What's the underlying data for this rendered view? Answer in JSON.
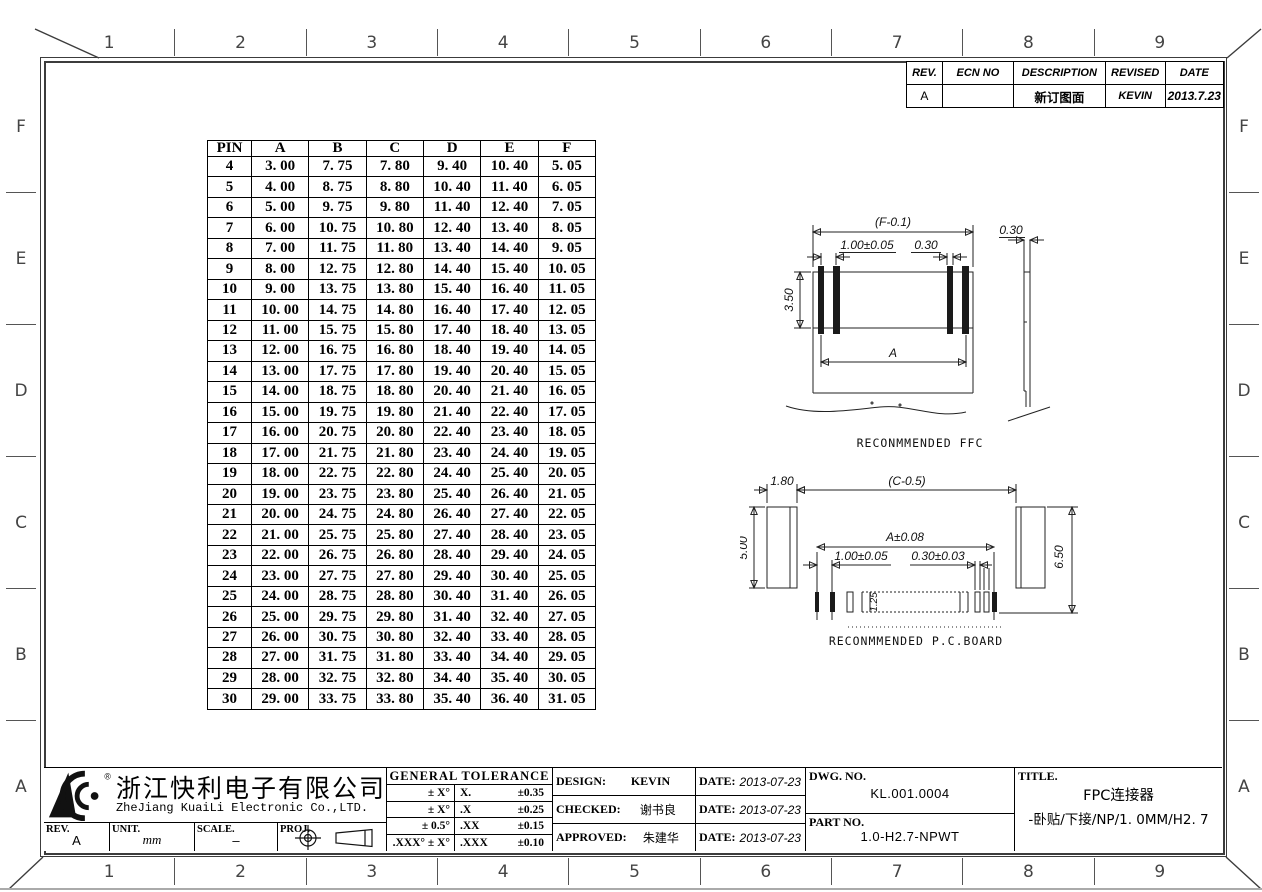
{
  "sheet": {
    "zone_columns": [
      "1",
      "2",
      "3",
      "4",
      "5",
      "6",
      "7",
      "8",
      "9"
    ],
    "zone_rows": [
      "F",
      "E",
      "D",
      "C",
      "B",
      "A"
    ]
  },
  "revision_table": {
    "headers": [
      "REV.",
      "ECN NO",
      "DESCRIPTION",
      "REVISED",
      "DATE"
    ],
    "rows": [
      [
        "A",
        "",
        "新订图面",
        "KEVIN",
        "2013.7.23"
      ]
    ]
  },
  "pin_table": {
    "headers": [
      "PIN",
      "A",
      "B",
      "C",
      "D",
      "E",
      "F"
    ],
    "rows": [
      [
        "4",
        "3. 00",
        "7. 75",
        "7. 80",
        "9. 40",
        "10. 40",
        "5. 05"
      ],
      [
        "5",
        "4. 00",
        "8. 75",
        "8. 80",
        "10. 40",
        "11. 40",
        "6. 05"
      ],
      [
        "6",
        "5. 00",
        "9. 75",
        "9. 80",
        "11. 40",
        "12. 40",
        "7. 05"
      ],
      [
        "7",
        "6. 00",
        "10. 75",
        "10. 80",
        "12. 40",
        "13. 40",
        "8. 05"
      ],
      [
        "8",
        "7. 00",
        "11. 75",
        "11. 80",
        "13. 40",
        "14. 40",
        "9. 05"
      ],
      [
        "9",
        "8. 00",
        "12. 75",
        "12. 80",
        "14. 40",
        "15. 40",
        "10. 05"
      ],
      [
        "10",
        "9. 00",
        "13. 75",
        "13. 80",
        "15. 40",
        "16. 40",
        "11. 05"
      ],
      [
        "11",
        "10. 00",
        "14. 75",
        "14. 80",
        "16. 40",
        "17. 40",
        "12. 05"
      ],
      [
        "12",
        "11. 00",
        "15. 75",
        "15. 80",
        "17. 40",
        "18. 40",
        "13. 05"
      ],
      [
        "13",
        "12. 00",
        "16. 75",
        "16. 80",
        "18. 40",
        "19. 40",
        "14. 05"
      ],
      [
        "14",
        "13. 00",
        "17. 75",
        "17. 80",
        "19. 40",
        "20. 40",
        "15. 05"
      ],
      [
        "15",
        "14. 00",
        "18. 75",
        "18. 80",
        "20. 40",
        "21. 40",
        "16. 05"
      ],
      [
        "16",
        "15. 00",
        "19. 75",
        "19. 80",
        "21. 40",
        "22. 40",
        "17. 05"
      ],
      [
        "17",
        "16. 00",
        "20. 75",
        "20. 80",
        "22. 40",
        "23. 40",
        "18. 05"
      ],
      [
        "18",
        "17. 00",
        "21. 75",
        "21. 80",
        "23. 40",
        "24. 40",
        "19. 05"
      ],
      [
        "19",
        "18. 00",
        "22. 75",
        "22. 80",
        "24. 40",
        "25. 40",
        "20. 05"
      ],
      [
        "20",
        "19. 00",
        "23. 75",
        "23. 80",
        "25. 40",
        "26. 40",
        "21. 05"
      ],
      [
        "21",
        "20. 00",
        "24. 75",
        "24. 80",
        "26. 40",
        "27. 40",
        "22. 05"
      ],
      [
        "22",
        "21. 00",
        "25. 75",
        "25. 80",
        "27. 40",
        "28. 40",
        "23. 05"
      ],
      [
        "23",
        "22. 00",
        "26. 75",
        "26. 80",
        "28. 40",
        "29. 40",
        "24. 05"
      ],
      [
        "24",
        "23. 00",
        "27. 75",
        "27. 80",
        "29. 40",
        "30. 40",
        "25. 05"
      ],
      [
        "25",
        "24. 00",
        "28. 75",
        "28. 80",
        "30. 40",
        "31. 40",
        "26. 05"
      ],
      [
        "26",
        "25. 00",
        "29. 75",
        "29. 80",
        "31. 40",
        "32. 40",
        "27. 05"
      ],
      [
        "27",
        "26. 00",
        "30. 75",
        "30. 80",
        "32. 40",
        "33. 40",
        "28. 05"
      ],
      [
        "28",
        "27. 00",
        "31. 75",
        "31. 80",
        "33. 40",
        "34. 40",
        "29. 05"
      ],
      [
        "29",
        "28. 00",
        "32. 75",
        "32. 80",
        "34. 40",
        "35. 40",
        "30. 05"
      ],
      [
        "30",
        "29. 00",
        "33. 75",
        "33. 80",
        "35. 40",
        "36. 40",
        "31. 05"
      ]
    ]
  },
  "ffc_drawing": {
    "label": "RECONMMENDED FFC",
    "dim_overall": "(F-0.1)",
    "dim_pitch": "1.00±0.05",
    "dim_conductor_width": "0.30",
    "dim_height": "3.50",
    "dim_span": "A",
    "dim_thickness": "0.30"
  },
  "pcb_drawing": {
    "label": "RECONMMENDED P.C.BOARD",
    "dim_end_width": "1.80",
    "dim_overall": "(C-0.5)",
    "dim_end_height": "5.00",
    "dim_span": "A±0.08",
    "dim_pitch": "1.00±0.05",
    "dim_pad_width": "0.30±0.03",
    "dim_pad_length": "1.25",
    "dim_total_height": "6.50"
  },
  "title_block": {
    "logo_mark": "®",
    "company_cn": "浙江快利电子有限公司",
    "company_en": "ZheJiang KuaiLi Electronic Co.,LTD.",
    "rev_label": "REV.",
    "rev_value": "A",
    "unit_label": "UNIT.",
    "unit_value": "mm",
    "scale_label": "SCALE.",
    "scale_value": "–",
    "proj_label": "PROJ.",
    "tolerance": {
      "title": "GENERAL TOLERANCE",
      "rows": [
        [
          "± X°",
          "X.",
          "±0.35"
        ],
        [
          "± X°",
          ".X",
          "±0.25"
        ],
        [
          "± 0.5°",
          ".XX",
          "±0.15"
        ],
        [
          ".XXX° ± X°",
          ".XXX",
          "±0.10"
        ]
      ]
    },
    "design_label": "DESIGN:",
    "design_value": "KEVIN",
    "design_date": "2013-07-23",
    "checked_label": "CHECKED:",
    "checked_value": "谢书良",
    "checked_date": "2013-07-23",
    "approved_label": "APPROVED:",
    "approved_value": "朱建华",
    "approved_date": "2013-07-23",
    "date_label": "DATE:",
    "dwg_no_label": "DWG. NO.",
    "dwg_no": "KL.001.0004",
    "part_no_label": "PART NO.",
    "part_no": "1.0-H2.7-NPWT",
    "title_label": "TITLE.",
    "title_line1": "FPC连接器",
    "title_line2": "-卧贴/下接/NP/1. 0MM/H2. 7"
  }
}
